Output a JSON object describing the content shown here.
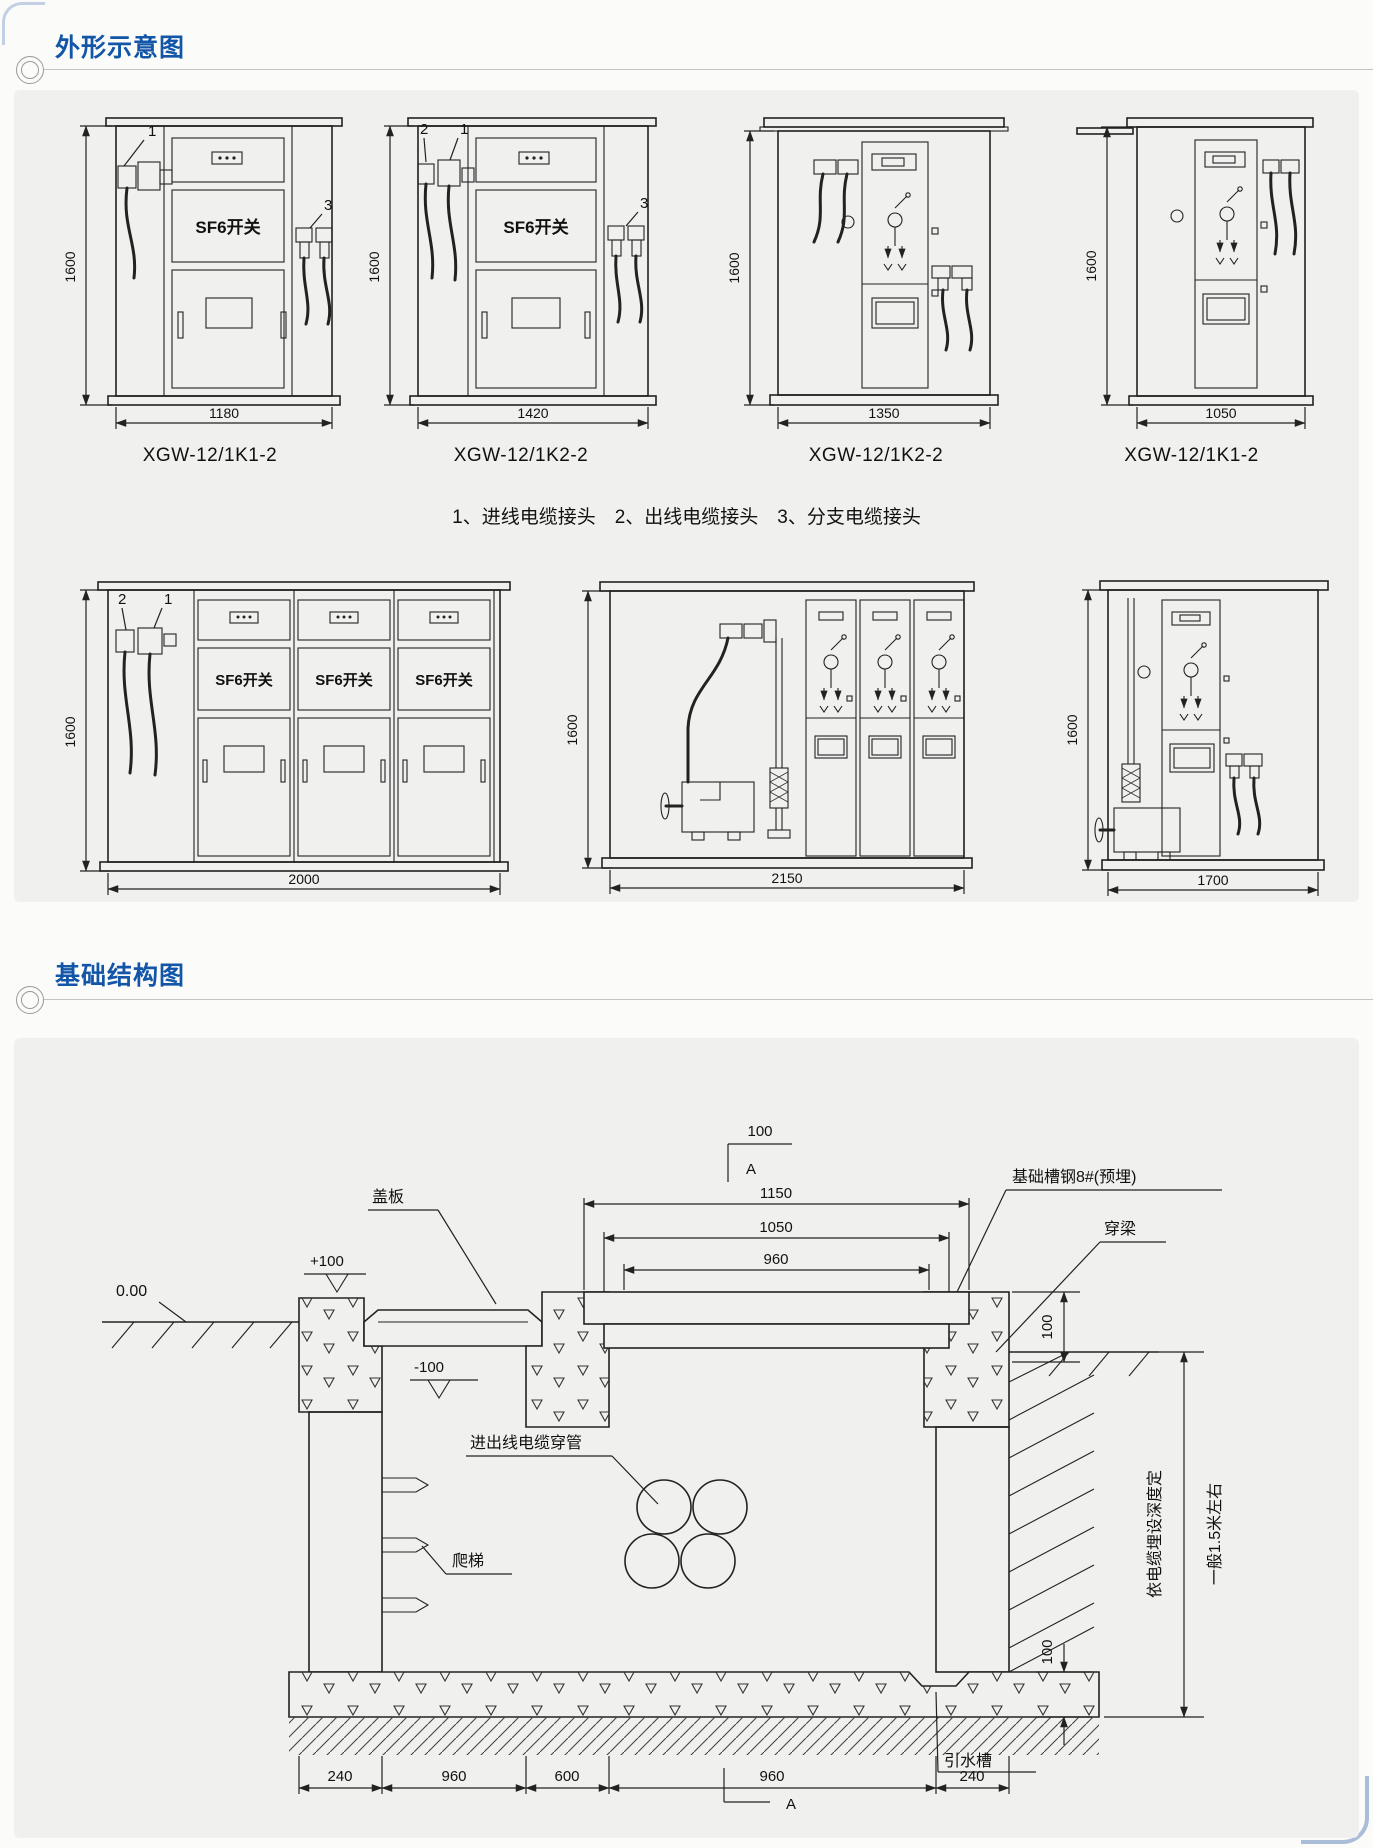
{
  "sections": {
    "s1": "外形示意图",
    "s2": "基础结构图"
  },
  "legend": "1、进线电缆接头　2、出线电缆接头　3、分支电缆接头",
  "row1": [
    {
      "model": "XGW-12/1K1-2",
      "w": "1180",
      "h": "1600",
      "c1": "1",
      "c3": "3",
      "sf6": "SF6开关"
    },
    {
      "model": "XGW-12/1K2-2",
      "w": "1420",
      "h": "1600",
      "c2": "2",
      "c1": "1",
      "c3": "3",
      "sf6": "SF6开关"
    },
    {
      "model": "XGW-12/1K2-2",
      "w": "1350",
      "h": "1600"
    },
    {
      "model": "XGW-12/1K1-2",
      "w": "1050",
      "h": "1600"
    }
  ],
  "row2": [
    {
      "w": "2000",
      "h": "1600",
      "c2": "2",
      "c1": "1",
      "bays": [
        "SF6开关",
        "SF6开关",
        "SF6开关"
      ]
    },
    {
      "w": "2150",
      "h": "1600"
    },
    {
      "w": "1700",
      "h": "1600"
    }
  ],
  "foundation": {
    "top_marker": {
      "d": "100",
      "a": "A"
    },
    "dims": {
      "d1150": "1150",
      "d1050": "1050",
      "d960": "960",
      "beam100": "100",
      "floor100": "100"
    },
    "levels": {
      "zero": "0.00",
      "plus": "+100",
      "minus": "-100"
    },
    "labels": {
      "cover": "盖板",
      "steel": "基础槽钢8#(预埋)",
      "beam": "穿梁",
      "pipes": "进出线电缆穿管",
      "ladder": "爬梯",
      "drain": "引水槽"
    },
    "bottom_dims": [
      "240",
      "960",
      "600",
      "960",
      "240"
    ],
    "bottom_marker": "A",
    "depth_note1": "依电缆埋设深度定",
    "depth_note2": "一般1.5米左右"
  }
}
